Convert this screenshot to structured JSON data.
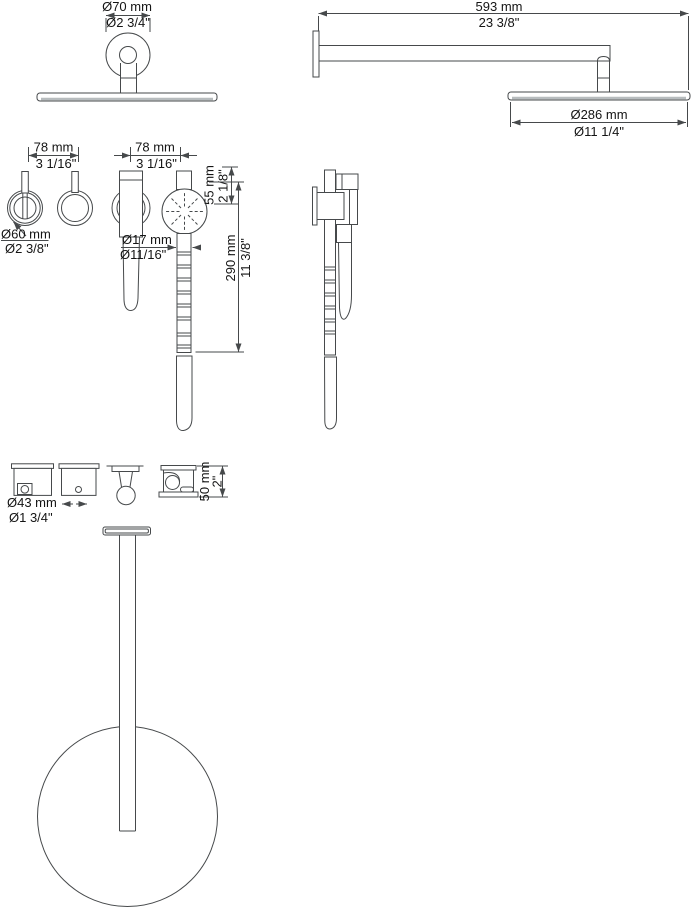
{
  "dimensions": {
    "overhead_shower_front": {
      "mm": "Ø70 mm",
      "in": "Ø2 3/4\""
    },
    "shower_arm_length": {
      "mm": "593 mm",
      "in": "23 3/8\""
    },
    "overhead_shower_diameter": {
      "mm": "Ø286 mm",
      "in": "Ø11 1/4\""
    },
    "valve_projection": {
      "mm": "78 mm",
      "in": "3 1/16\""
    },
    "valve_escutcheon_diameter": {
      "mm": "Ø60 mm",
      "in": "Ø2 3/8\""
    },
    "hand_shower_projection": {
      "mm": "78 mm",
      "in": "3 1/16\""
    },
    "hand_shower_head": {
      "mm": "55 mm",
      "in": "2 1/8\""
    },
    "hand_shower_handle_diameter": {
      "mm": "Ø17 mm",
      "in": "Ø11/16\""
    },
    "hand_shower_length": {
      "mm": "290 mm",
      "in": "11 3/8\""
    },
    "trim_diameter": {
      "mm": "Ø43 mm",
      "in": "Ø1 3/4\""
    },
    "bracket_depth": {
      "mm": "50 mm",
      "in": "2\""
    }
  },
  "colors": {
    "line": "#46494b",
    "text": "#141414",
    "plate_shade": "#b7bcbe",
    "background": "#ffffff"
  }
}
